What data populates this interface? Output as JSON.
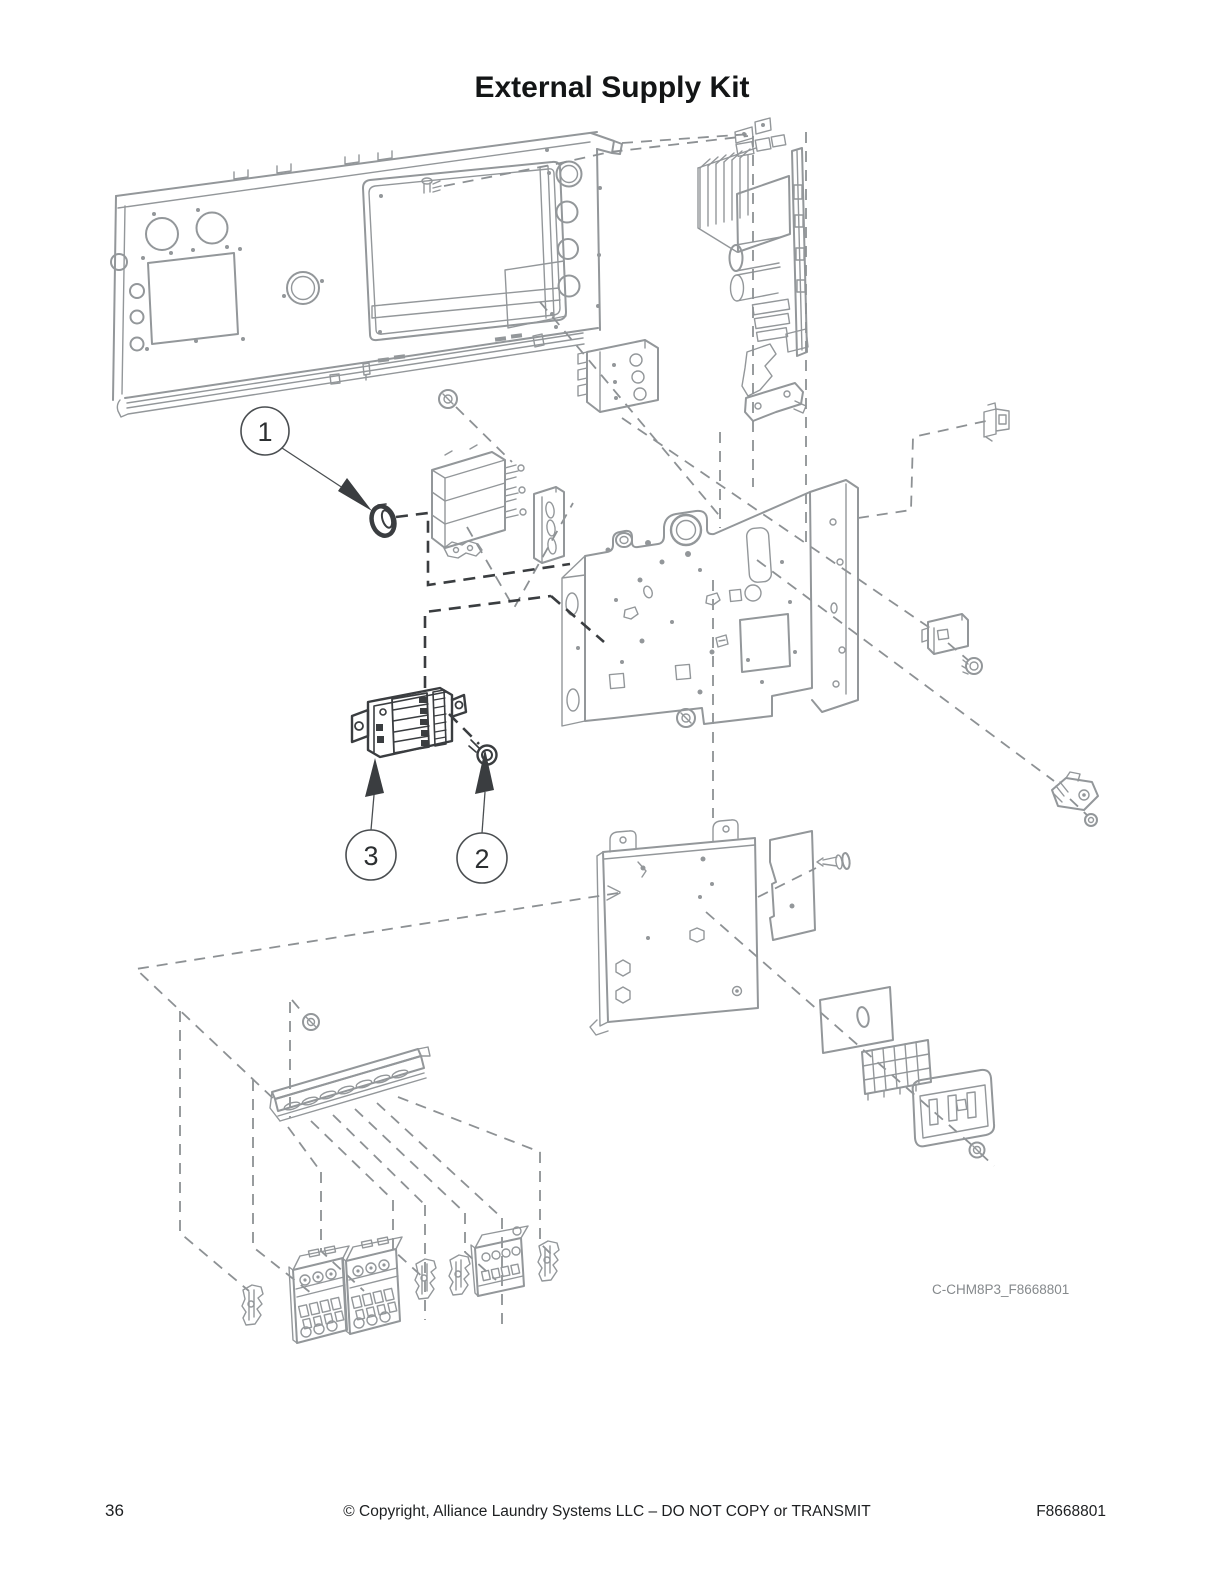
{
  "page": {
    "title": "External Supply Kit",
    "figure_code": "C-CHM8P3_F8668801",
    "footer": {
      "page_number": "36",
      "copyright": "© Copyright, Alliance Laundry Systems LLC – DO NOT COPY or TRANSMIT",
      "doc_number": "F8668801"
    }
  },
  "callouts": [
    {
      "id": 1,
      "label": "1"
    },
    {
      "id": 2,
      "label": "2"
    },
    {
      "id": 3,
      "label": "3"
    }
  ],
  "colors": {
    "diagram_line": "#93979a",
    "highlight_dark": "#3a3d40",
    "text": "#1d1f21",
    "caption": "#85898c",
    "background": "#ffffff"
  }
}
